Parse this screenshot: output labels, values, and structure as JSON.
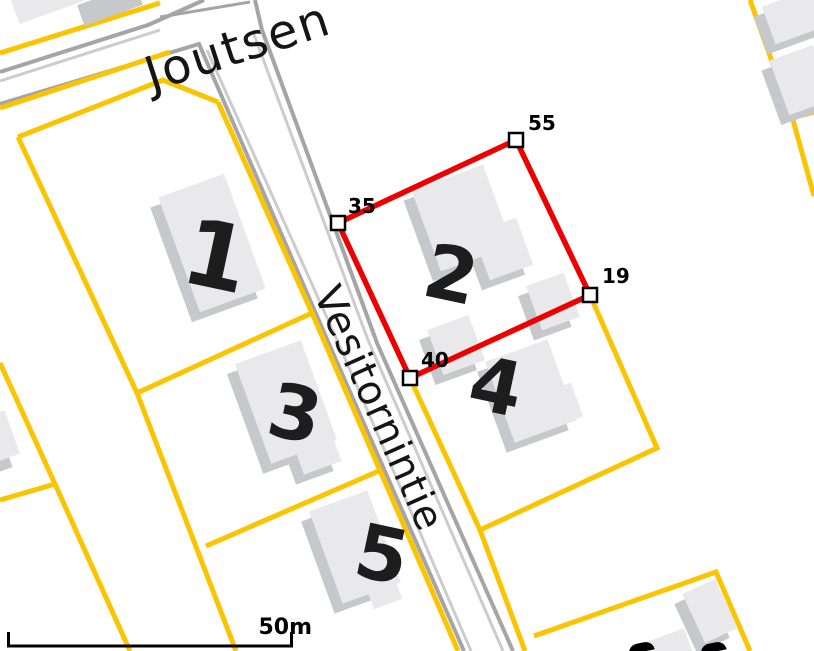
{
  "map": {
    "type": "cadastral-map",
    "streets": [
      {
        "name": "Joutsen"
      },
      {
        "name": "Vesitornintie"
      }
    ],
    "plots": [
      {
        "number": "1"
      },
      {
        "number": "2"
      },
      {
        "number": "3"
      },
      {
        "number": "4"
      },
      {
        "number": "5"
      }
    ],
    "measurement": {
      "shape": "polygon",
      "stroke_color": "#ee0000",
      "vertices": [
        {
          "label": "35"
        },
        {
          "label": "55"
        },
        {
          "label": "19"
        },
        {
          "label": "40"
        }
      ]
    },
    "scale_bar": {
      "label": "50m"
    },
    "colors": {
      "parcel_line": "#fcc400",
      "road_edge": "#a5a5a5",
      "road_edge_inner": "#cccccc",
      "building": "#e9e9eb",
      "building_shadow": "#c6c8cb",
      "background": "#ffffff",
      "text": "#1d1d1d"
    }
  }
}
